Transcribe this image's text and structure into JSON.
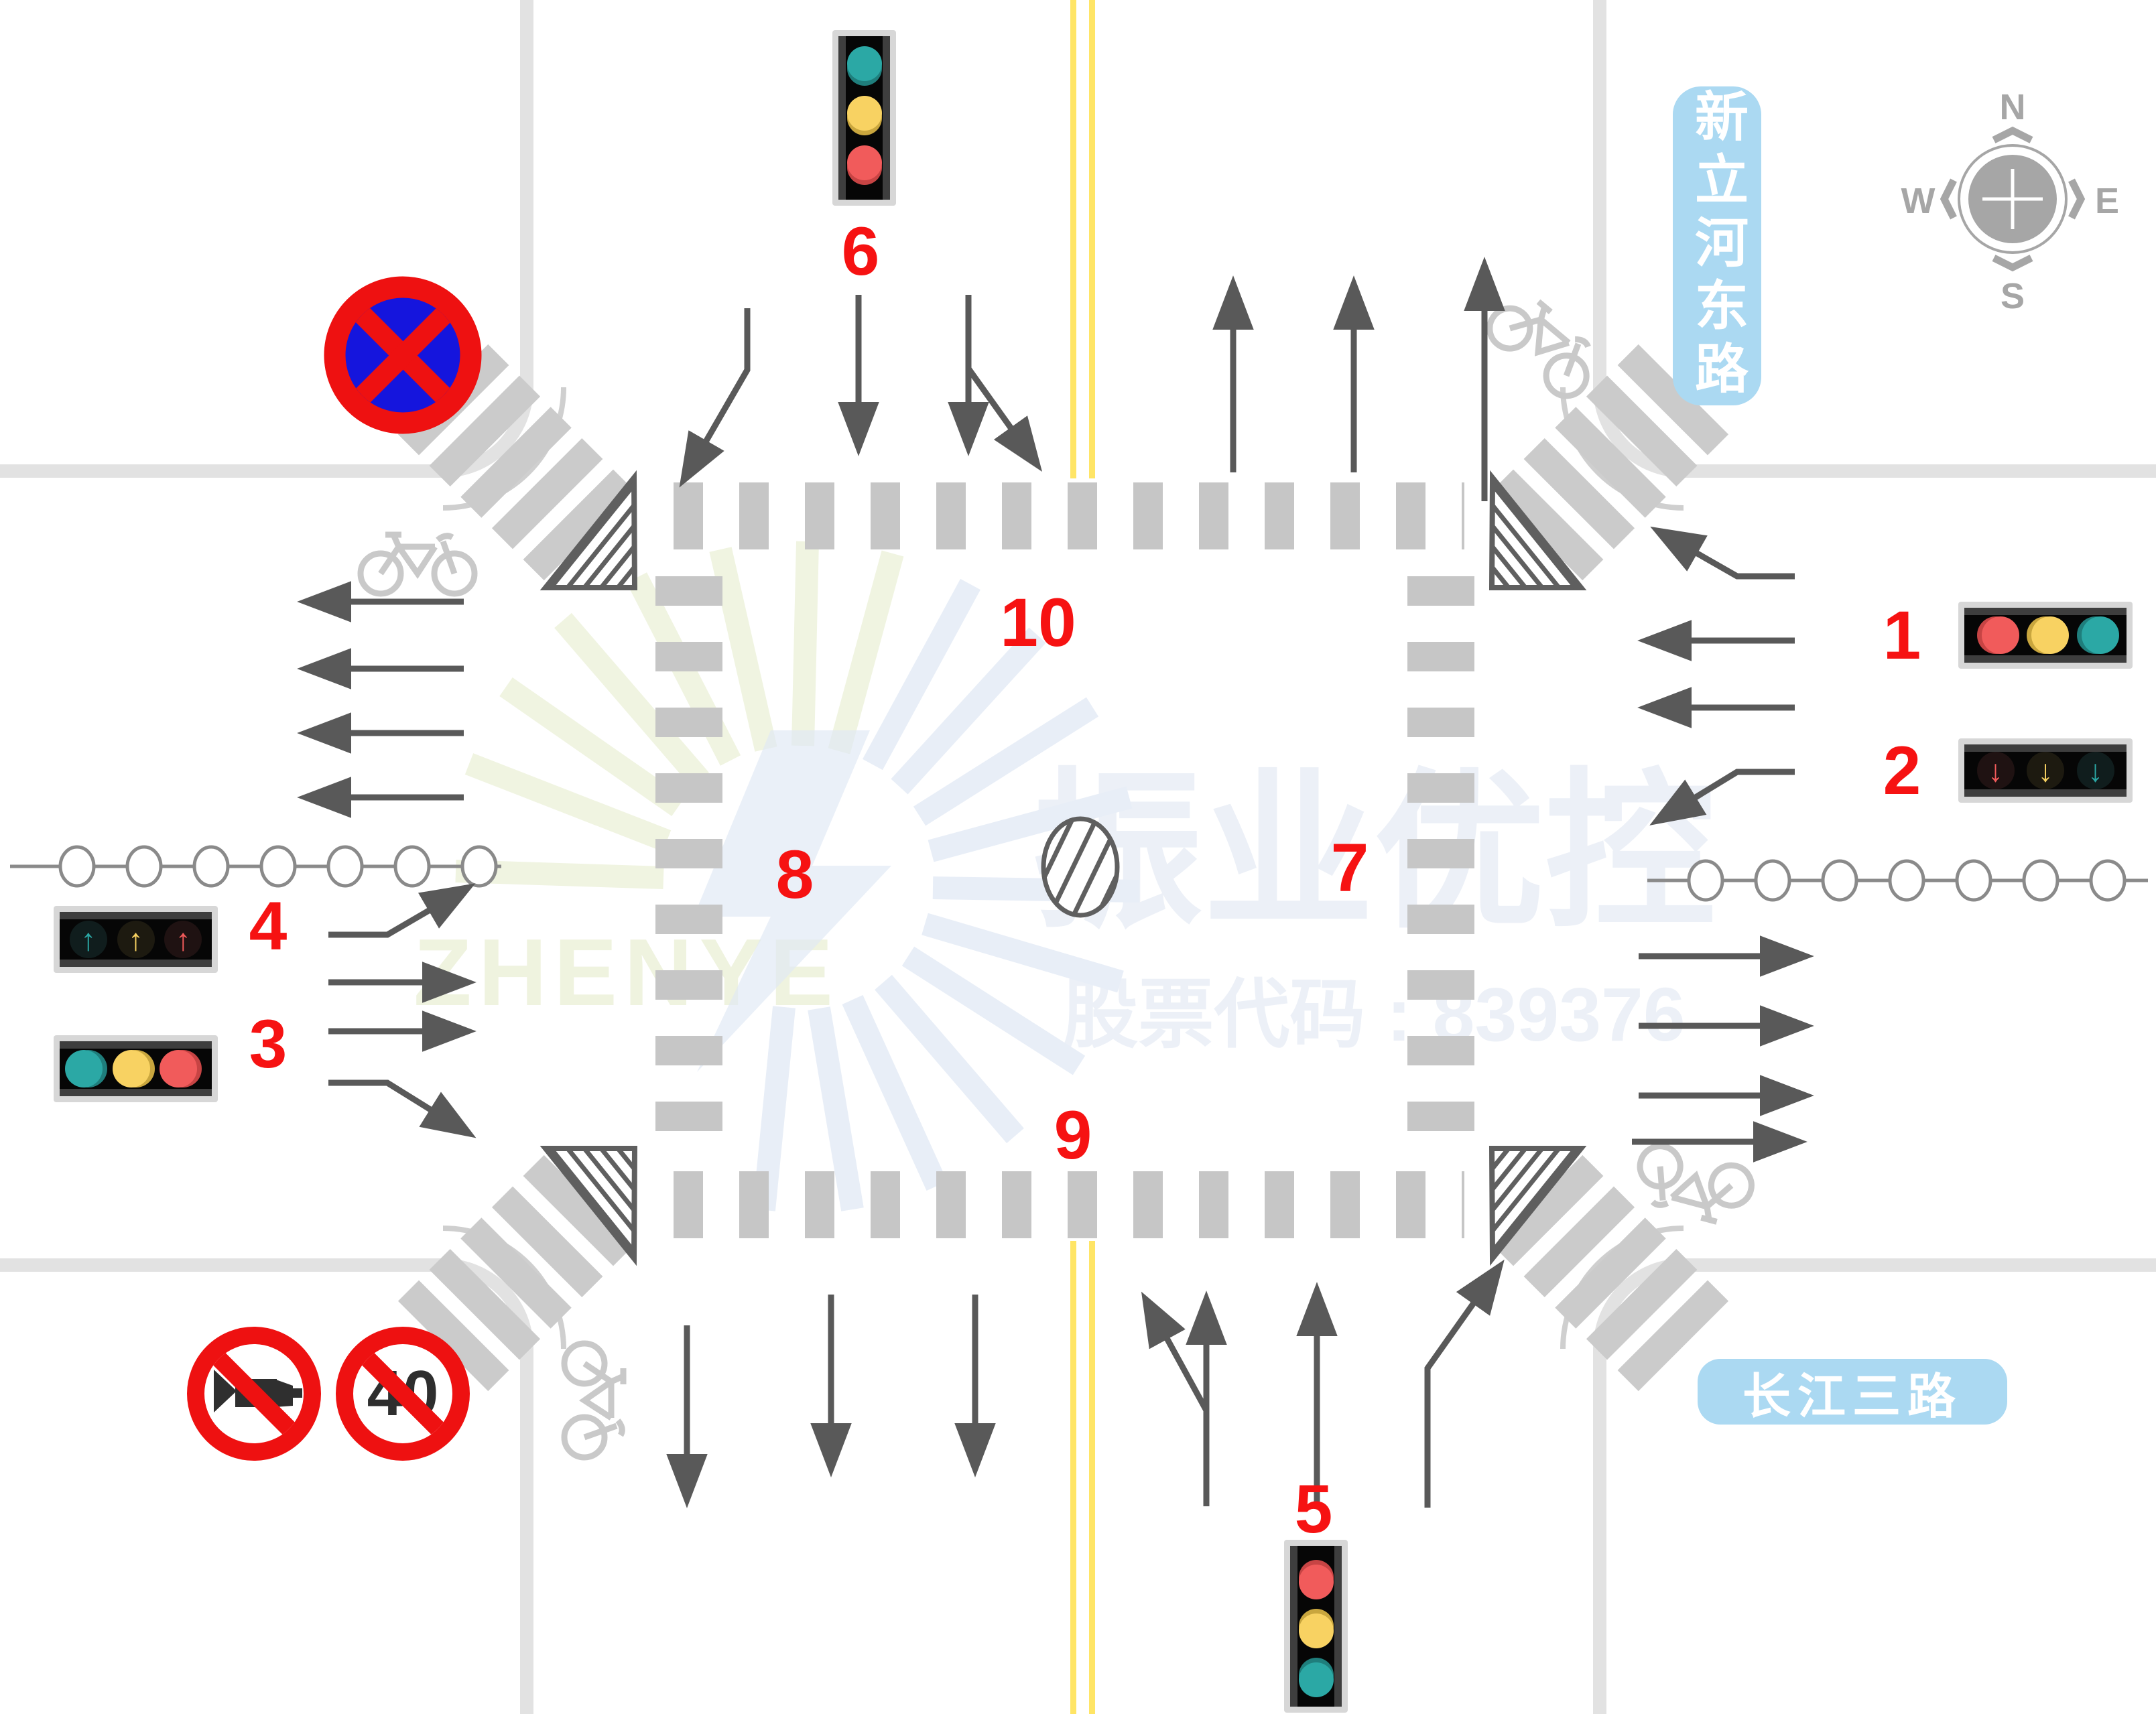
{
  "markers": {
    "m1": "1",
    "m2": "2",
    "m3": "3",
    "m4": "4",
    "m5": "5",
    "m6": "6",
    "m7": "7",
    "m8": "8",
    "m9": "9",
    "m10": "10"
  },
  "roads": {
    "north_plate": "新立河东路",
    "south_plate": "长江三路"
  },
  "compass": {
    "n": "N",
    "e": "E",
    "s": "S",
    "w": "W"
  },
  "signs": {
    "speed_limit": "40"
  },
  "watermark": {
    "brand": "振业优控",
    "stock_line": "股票代码 : 839376",
    "logo_text": "ZHENYE"
  },
  "glyphs": {
    "up_arrow": "↑",
    "down_arrow": "↓"
  },
  "colors": {
    "signal_red": "#F15B5B",
    "signal_red_dark": "#C74444",
    "signal_yellow": "#F8D262",
    "signal_yellow_dark": "#C9A63E",
    "signal_teal": "#2BA8A5",
    "signal_teal_dark": "#1F7E7C",
    "marker_red": "#F61212",
    "sign_red": "#EE1111",
    "sign_blue": "#1515DD",
    "plate_blue": "#ABD9F2",
    "lane_yellow": "#FFE566"
  }
}
